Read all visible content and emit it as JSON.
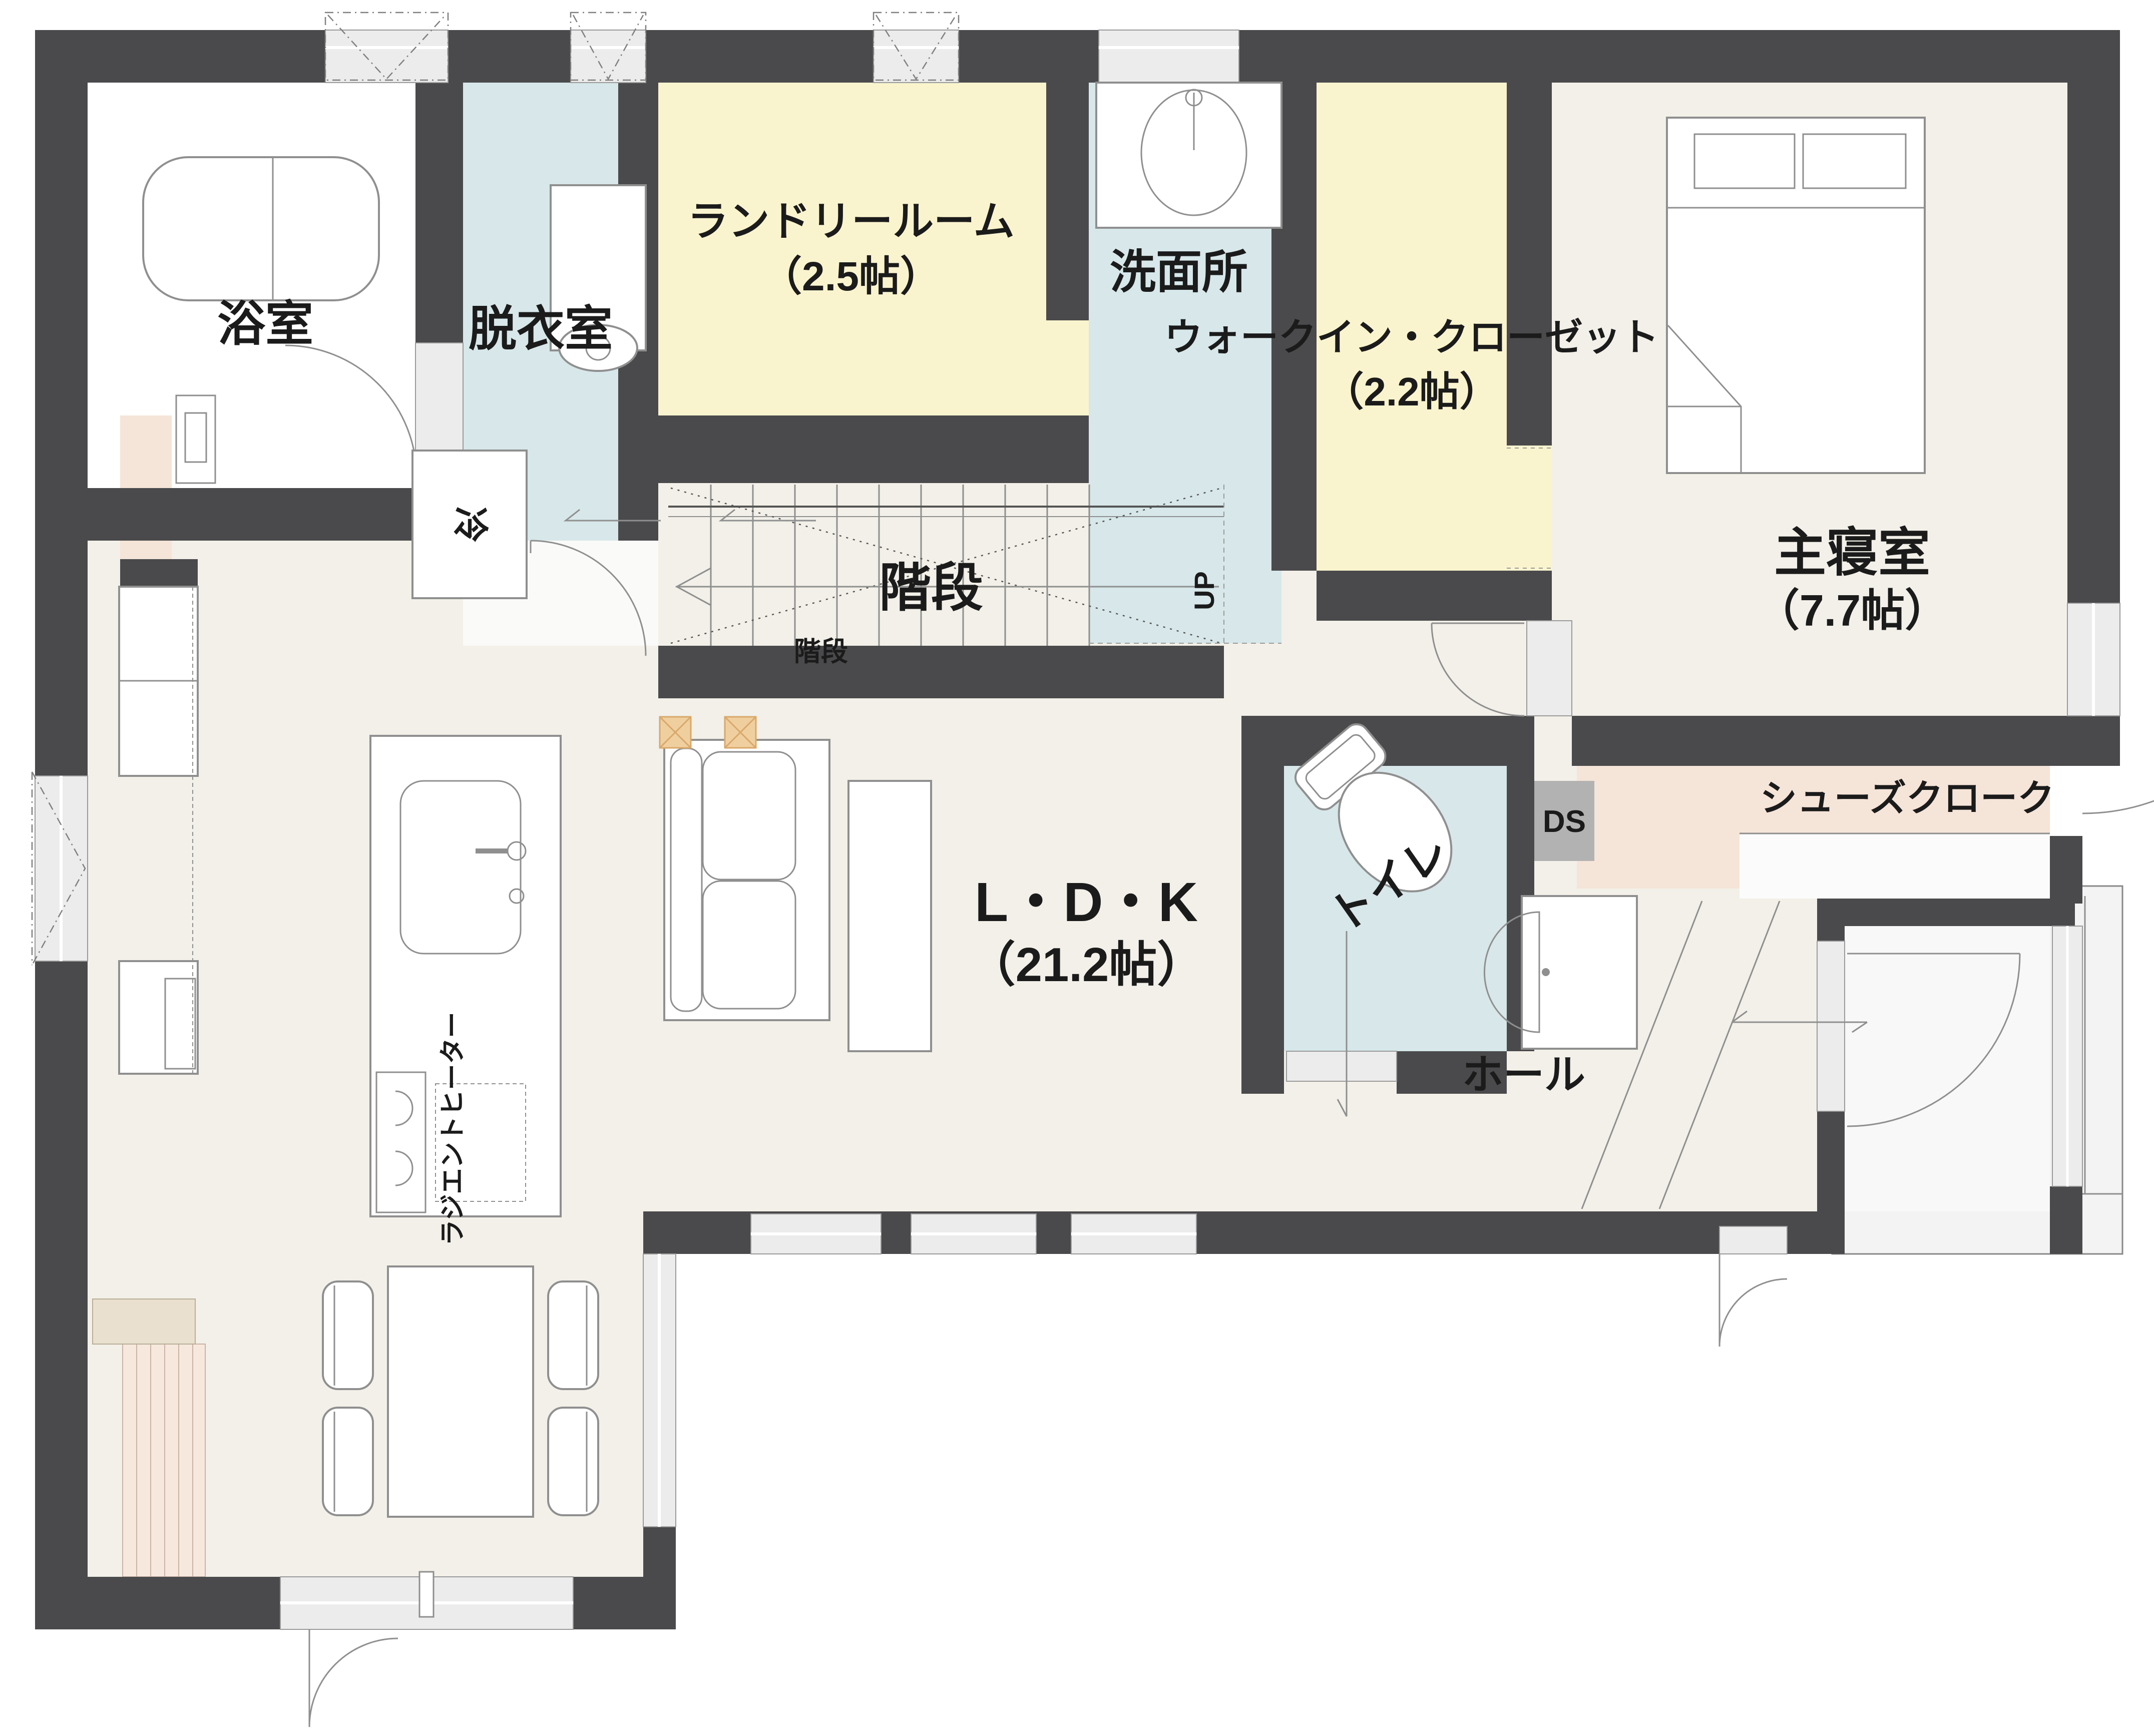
{
  "plan": {
    "colors": {
      "wall": "#4a4a4c",
      "floor_beige": "#f2f0e8",
      "floor_blue": "#d7e7ea",
      "floor_yellow": "#faf4ce",
      "floor_pink": "#f5e4d8",
      "ds_gray": "#b2b2b2"
    },
    "rooms": {
      "bathroom": {
        "label": "浴室"
      },
      "dressing": {
        "label": "脱衣室"
      },
      "laundry": {
        "label": "ランドリールーム",
        "area": "（2.5帖）"
      },
      "washroom": {
        "label": "洗面所"
      },
      "wic": {
        "label": "ウォークイン・クローゼット",
        "area": "（2.2帖）"
      },
      "bedroom": {
        "label": "主寝室",
        "area": "（7.7帖）"
      },
      "stairs": {
        "label": "階段",
        "label_small": "階段",
        "up": "UP"
      },
      "toilet": {
        "label": "トイレ"
      },
      "ds": {
        "label": "DS"
      },
      "shoes": {
        "label": "シューズクローク"
      },
      "ldk": {
        "label": "L・D・K",
        "area": "（21.2帖）"
      },
      "hall": {
        "label": "ホール"
      }
    },
    "furniture": {
      "fridge": "冷",
      "heater": "ラジエントヒーター"
    }
  }
}
